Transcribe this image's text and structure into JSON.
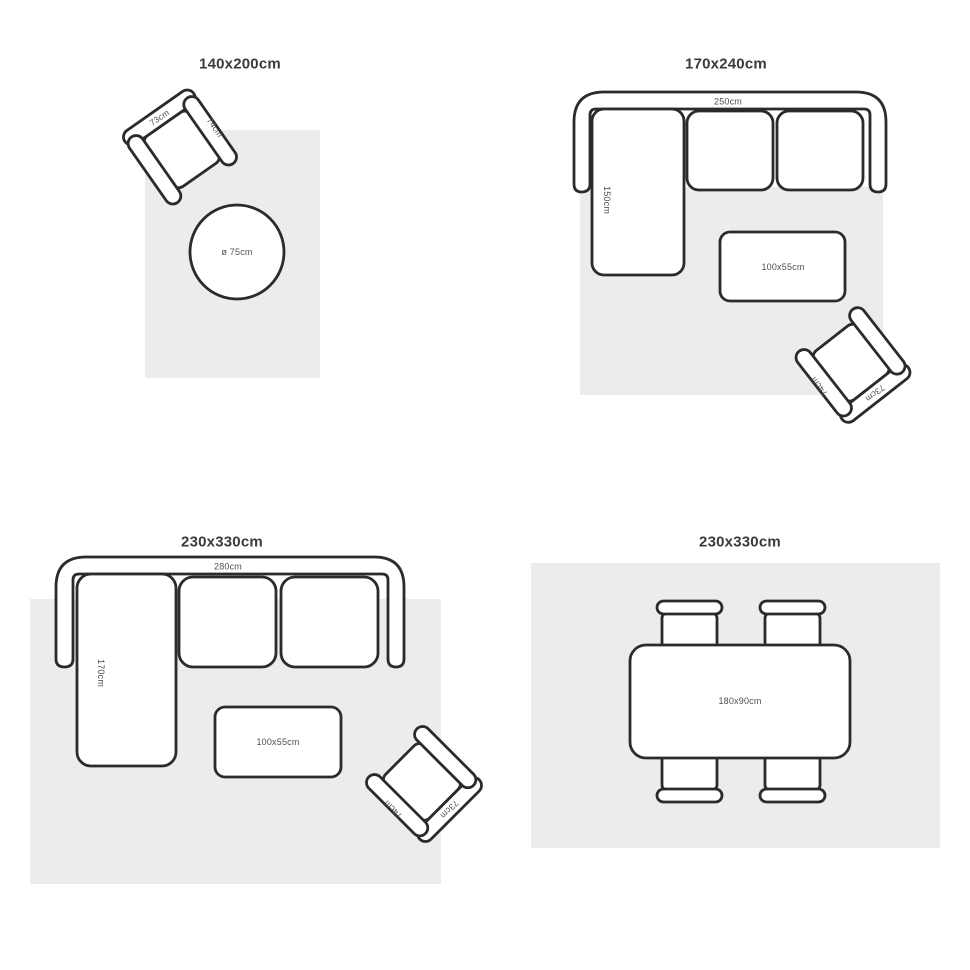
{
  "colors": {
    "bg": "#ffffff",
    "outline": "#2b2b2b",
    "rug": "#ececec",
    "dim": "#4f4f4f",
    "title": "#3a3a3a"
  },
  "panels": [
    {
      "title": "140x200cm",
      "armchair": {
        "back_width": "73cm",
        "arm_depth": "74cm"
      },
      "round_table": {
        "diameter": "ø 75cm"
      }
    },
    {
      "title": "170x240cm",
      "sofa": {
        "width": "250cm",
        "chaise_depth": "150cm"
      },
      "coffee_table": {
        "size": "100x55cm"
      },
      "armchair": {
        "back_width": "73cm",
        "arm_depth": "74cm"
      }
    },
    {
      "title": "230x330cm",
      "sofa": {
        "width": "280cm",
        "chaise_depth": "170cm"
      },
      "coffee_table": {
        "size": "100x55cm"
      },
      "armchair": {
        "back_width": "73cm",
        "arm_depth": "74cm"
      }
    },
    {
      "title": "230x330cm",
      "dining_table": {
        "size": "180x90cm"
      }
    }
  ]
}
